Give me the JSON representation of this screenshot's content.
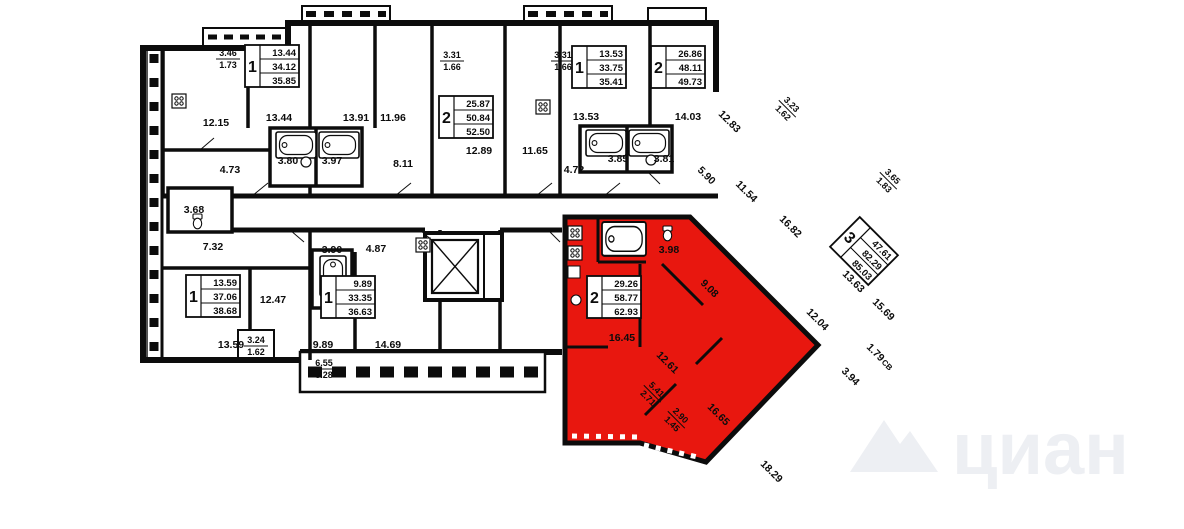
{
  "watermark": {
    "text": "циан",
    "color": "#edeff3"
  },
  "colors": {
    "highlight": "#e8170f",
    "wall": "#0c0c0c",
    "background": "#ffffff"
  },
  "legend": {
    "highlighted_unit": "2-room apartment 29.26 / 58.77 / 62.93"
  },
  "apartment_boxes": [
    {
      "rooms": "1",
      "values": [
        "13.44",
        "34.12",
        "35.85"
      ],
      "x": 272,
      "y": 66,
      "rot": 0
    },
    {
      "rooms": "2",
      "values": [
        "25.87",
        "50.84",
        "52.50"
      ],
      "x": 466,
      "y": 117,
      "rot": 0
    },
    {
      "rooms": "1",
      "values": [
        "13.53",
        "33.75",
        "35.41"
      ],
      "x": 599,
      "y": 67,
      "rot": 0
    },
    {
      "rooms": "2",
      "values": [
        "26.86",
        "48.11",
        "49.73"
      ],
      "x": 678,
      "y": 67,
      "rot": 0
    },
    {
      "rooms": "1",
      "values": [
        "13.59",
        "37.06",
        "38.68"
      ],
      "x": 213,
      "y": 296,
      "rot": 0
    },
    {
      "rooms": "1",
      "values": [
        "9.89",
        "33.35",
        "36.63"
      ],
      "x": 348,
      "y": 297,
      "rot": 0
    },
    {
      "rooms": "2",
      "values": [
        "29.26",
        "58.77",
        "62.93"
      ],
      "x": 614,
      "y": 297,
      "rot": 0,
      "highlighted": true
    },
    {
      "rooms": "3",
      "values": [
        "47.61",
        "82.29",
        "85.03"
      ],
      "x": 864,
      "y": 251,
      "rot": 45
    }
  ],
  "room_labels": [
    {
      "t": "3.46",
      "b": "1.73",
      "x": 228,
      "y": 58,
      "r": 0
    },
    {
      "t": "12.15",
      "x": 216,
      "y": 122,
      "r": 0
    },
    {
      "t": "13.44",
      "x": 279,
      "y": 117,
      "r": 0
    },
    {
      "t": "13.91",
      "x": 356,
      "y": 117,
      "r": 0
    },
    {
      "t": "11.96",
      "x": 393,
      "y": 117,
      "r": 0
    },
    {
      "t": "3.80",
      "x": 288,
      "y": 160,
      "r": 0
    },
    {
      "t": "3.97",
      "x": 332,
      "y": 160,
      "r": 0
    },
    {
      "t": "8.11",
      "x": 403,
      "y": 163,
      "r": 0
    },
    {
      "t": "4.73",
      "x": 230,
      "y": 169,
      "r": 0
    },
    {
      "t": "3.68",
      "x": 194,
      "y": 209,
      "r": 0
    },
    {
      "t": "3.31",
      "b": "1.66",
      "x": 452,
      "y": 60,
      "r": 0
    },
    {
      "t": "3.31",
      "b": "1.66",
      "x": 563,
      "y": 60,
      "r": 0
    },
    {
      "t": "13.53",
      "x": 586,
      "y": 116,
      "r": 0
    },
    {
      "t": "14.03",
      "x": 688,
      "y": 116,
      "r": 0
    },
    {
      "t": "12.89",
      "x": 479,
      "y": 150,
      "r": 0
    },
    {
      "t": "11.65",
      "x": 535,
      "y": 150,
      "r": 0
    },
    {
      "t": "4.72",
      "x": 574,
      "y": 169,
      "r": 0
    },
    {
      "t": "3.85",
      "x": 618,
      "y": 158,
      "r": 0
    },
    {
      "t": "3.81",
      "x": 664,
      "y": 158,
      "r": 0
    },
    {
      "t": "5.90",
      "x": 707,
      "y": 175,
      "r": 45
    },
    {
      "t": "12.83",
      "x": 730,
      "y": 121,
      "r": 45
    },
    {
      "t": "3.23",
      "b": "1.62",
      "x": 788,
      "y": 108,
      "r": 45
    },
    {
      "t": "11.54",
      "x": 747,
      "y": 191,
      "r": 45
    },
    {
      "t": "16.82",
      "x": 791,
      "y": 226,
      "r": 45
    },
    {
      "t": "3.65",
      "b": "1.83",
      "x": 889,
      "y": 180,
      "r": 45
    },
    {
      "t": "13.63",
      "x": 854,
      "y": 281,
      "r": 45
    },
    {
      "t": "15.69",
      "x": 884,
      "y": 309,
      "r": 45
    },
    {
      "t": "12.04",
      "x": 818,
      "y": 319,
      "r": 45
    },
    {
      "t": "1.79",
      "x": 876,
      "y": 352,
      "r": 45
    },
    {
      "t": "СВ",
      "x": 888,
      "y": 364,
      "r": 45,
      "s": 8
    },
    {
      "t": "3.94",
      "x": 851,
      "y": 376,
      "r": 45
    },
    {
      "t": "18.29",
      "x": 772,
      "y": 471,
      "r": 45
    },
    {
      "t": "7.32",
      "x": 213,
      "y": 246,
      "r": 0
    },
    {
      "t": "3.90",
      "x": 332,
      "y": 249,
      "r": 0
    },
    {
      "t": "4.87",
      "x": 376,
      "y": 248,
      "r": 0
    },
    {
      "t": "12.47",
      "x": 273,
      "y": 299,
      "r": 0
    },
    {
      "t": "13.59",
      "x": 231,
      "y": 344,
      "r": 0
    },
    {
      "t": "3.24",
      "b": "1.62",
      "x": 256,
      "y": 345,
      "r": 0
    },
    {
      "t": "9.89",
      "x": 323,
      "y": 344,
      "r": 0
    },
    {
      "t": "14.69",
      "x": 388,
      "y": 344,
      "r": 0
    },
    {
      "t": "6.55",
      "b": "3.28",
      "x": 324,
      "y": 368,
      "r": 0
    },
    {
      "t": "3.98",
      "x": 669,
      "y": 249,
      "r": 0
    },
    {
      "t": "9.08",
      "x": 710,
      "y": 288,
      "r": 45
    },
    {
      "t": "16.45",
      "x": 622,
      "y": 337,
      "r": 0
    },
    {
      "t": "12.61",
      "x": 668,
      "y": 362,
      "r": 45
    },
    {
      "t": "16.65",
      "x": 719,
      "y": 414,
      "r": 45
    },
    {
      "t": "5.41",
      "b": "2.71",
      "x": 653,
      "y": 393,
      "r": 45
    },
    {
      "t": "2.90",
      "b": "1.45",
      "x": 677,
      "y": 419,
      "r": 45
    }
  ]
}
